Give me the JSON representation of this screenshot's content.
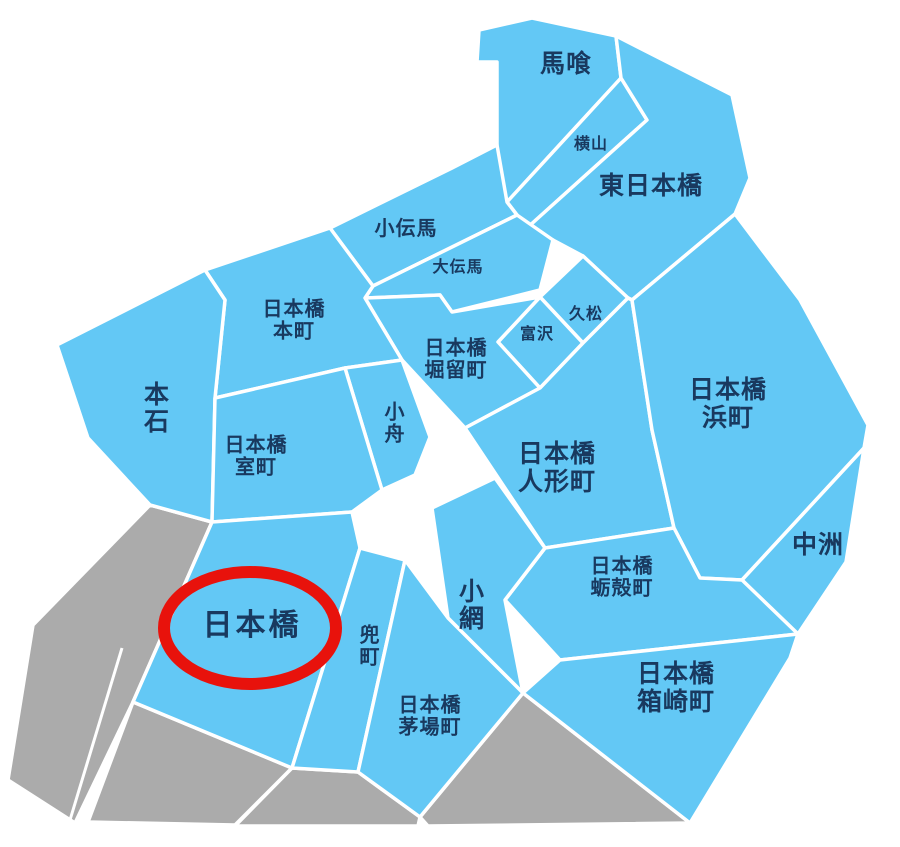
{
  "map": {
    "background_color": "#FFFFFF",
    "region_color": "#63C8F5",
    "neighbor_region_color": "#ABABAB",
    "border_color": "#FFFFFF",
    "label_color": "#19395F",
    "highlight": {
      "district": "日本橋",
      "marker": "red-ellipse",
      "color": "#E8120C"
    },
    "districts": [
      {
        "id": "bakuro",
        "label": "馬喰"
      },
      {
        "id": "yokoyama",
        "label": "横山"
      },
      {
        "id": "higashi-nihonbashi",
        "label": "東日本橋"
      },
      {
        "id": "kodenma",
        "label": "小伝馬"
      },
      {
        "id": "odenma",
        "label": "大伝馬"
      },
      {
        "id": "nihonbashi-honcho",
        "label": "日本橋\n本町"
      },
      {
        "id": "hisamatsu",
        "label": "久松"
      },
      {
        "id": "tomizawa",
        "label": "富沢"
      },
      {
        "id": "nihonbashi-horidomecho",
        "label": "日本橋\n堀留町"
      },
      {
        "id": "hongoku",
        "label": "本石"
      },
      {
        "id": "kobuna",
        "label": "小舟"
      },
      {
        "id": "nihonbashi-hamacho",
        "label": "日本橋\n浜町"
      },
      {
        "id": "nihonbashi-muromachi",
        "label": "日本橋\n室町"
      },
      {
        "id": "nihonbashi-ningyocho",
        "label": "日本橋\n人形町"
      },
      {
        "id": "nakasu",
        "label": "中洲"
      },
      {
        "id": "nihonbashi-kakigaracho",
        "label": "日本橋\n蛎殻町"
      },
      {
        "id": "koami",
        "label": "小網"
      },
      {
        "id": "nihonbashi",
        "label": "日本橋",
        "highlighted": true
      },
      {
        "id": "kabutocho",
        "label": "兜町"
      },
      {
        "id": "nihonbashi-kayabacho",
        "label": "日本橋\n茅場町"
      },
      {
        "id": "nihonbashi-hakozakicho",
        "label": "日本橋\n箱崎町"
      }
    ]
  }
}
